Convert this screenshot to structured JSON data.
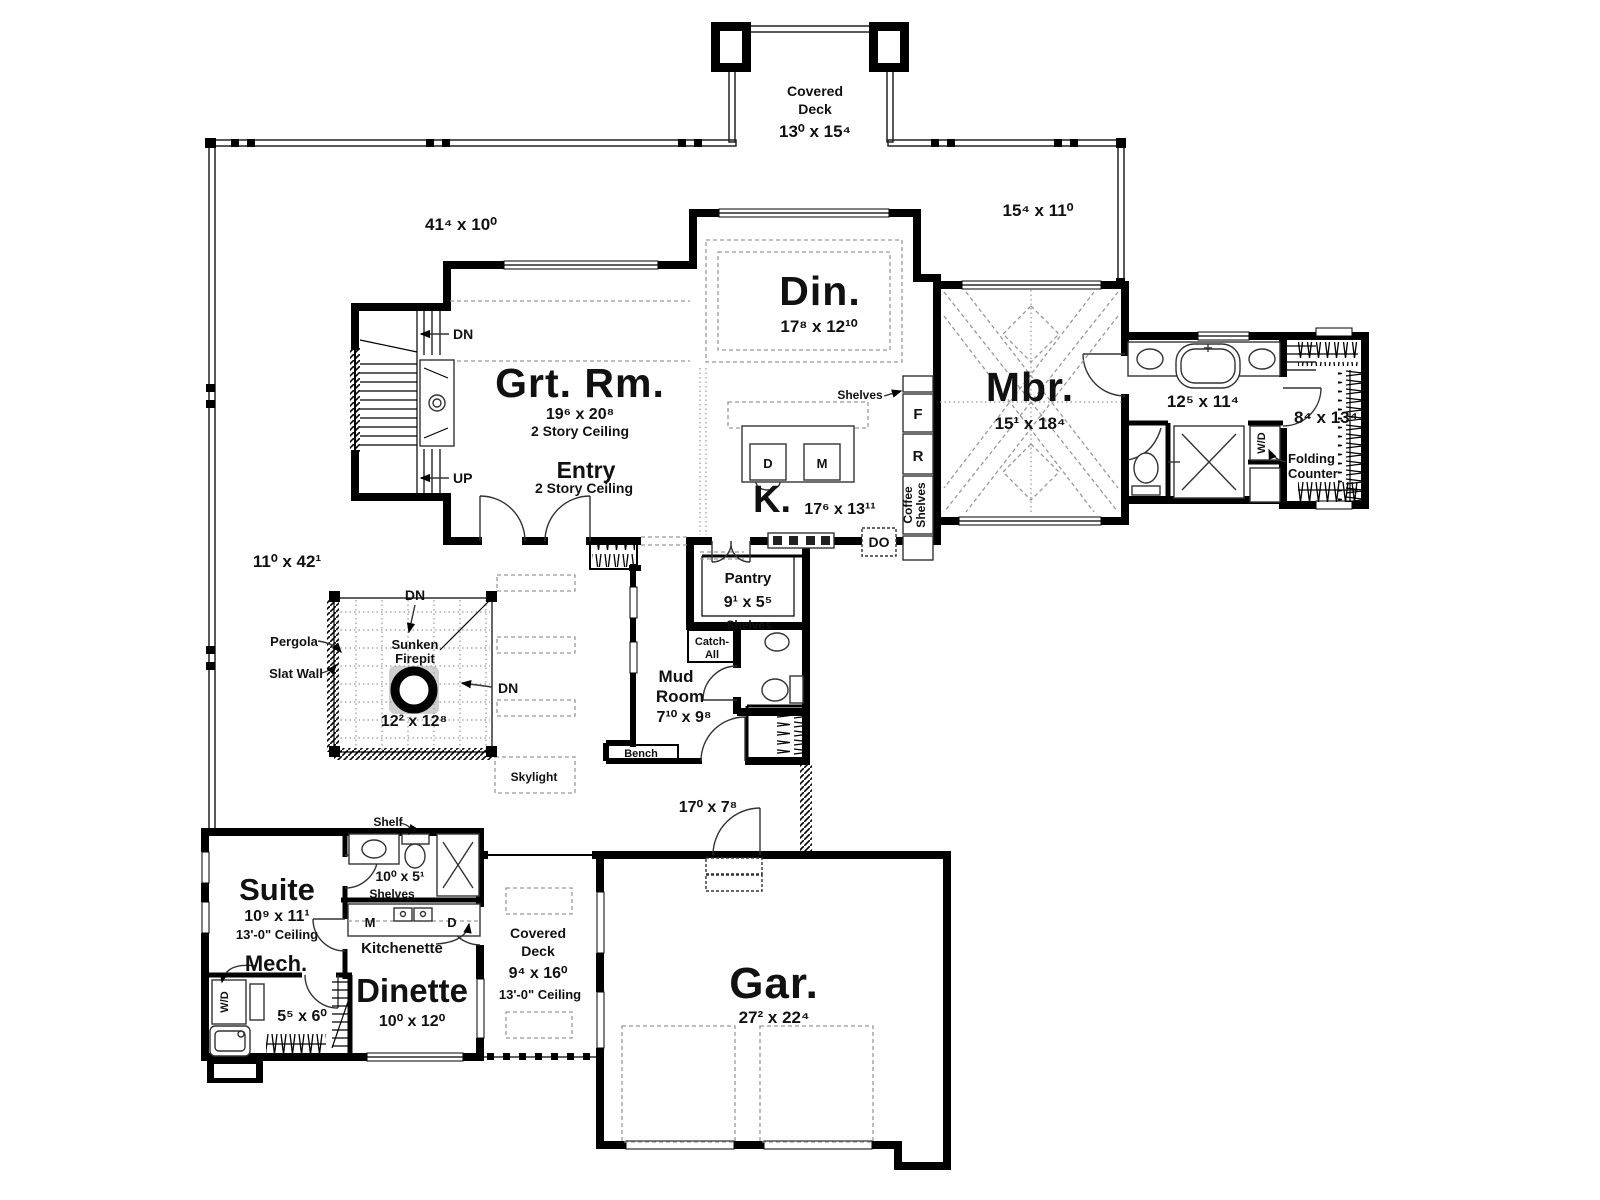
{
  "deck_top": {
    "line1": "Covered",
    "line2": "Deck",
    "dim": "13⁰ x 15⁴"
  },
  "deck_dims": {
    "top_left": "41⁴ x 10⁰",
    "right": "15⁴ x 11⁰",
    "left": "11⁰ x 42¹"
  },
  "great_room": {
    "name": "Grt. Rm.",
    "dim": "19⁶ x 20⁸",
    "ceiling": "2 Story Ceiling"
  },
  "entry": {
    "name": "Entry",
    "ceiling": "2 Story Ceiling"
  },
  "dining": {
    "name": "Din.",
    "dim": "17⁸ x 12¹⁰"
  },
  "kitchen": {
    "name": "K.",
    "dim": "17⁶ x 13¹¹",
    "d": "D",
    "m": "M",
    "f": "F",
    "r": "R",
    "do_label": "DO",
    "shelves": "Shelves",
    "coffee1": "Coffee",
    "coffee2": "Shelves"
  },
  "master": {
    "name": "Mbr.",
    "dim": "15¹ x 18⁴"
  },
  "master_bath": {
    "dim": "12⁵ x 11⁴",
    "wd": "W/D"
  },
  "master_closet": {
    "dim": "8⁴ x 13⁴",
    "folding1": "Folding",
    "folding2": "Counter"
  },
  "pantry": {
    "name": "Pantry",
    "dim": "9¹ x 5⁵",
    "shelves": "Shelves"
  },
  "mud_room": {
    "line1": "Mud",
    "line2": "Room",
    "dim": "7¹⁰ x 9⁸",
    "catch1": "Catch-",
    "catch2": "All",
    "bench": "Bench"
  },
  "stairs": {
    "dn": "DN",
    "up": "UP"
  },
  "pergola": {
    "label": "Pergola",
    "slat_wall": "Slat Wall",
    "firepit1": "Sunken",
    "firepit2": "Firepit",
    "firepit_dim": "12² x 12⁸",
    "dn": "DN",
    "skylight": "Skylight"
  },
  "walkway": {
    "dim": "17⁰ x 7⁸"
  },
  "suite": {
    "name": "Suite",
    "dim": "10⁹ x 11¹",
    "ceiling": "13'-0\" Ceiling",
    "shelf": "Shelf",
    "bath_dim": "10⁰ x 5¹",
    "shelves": "Shelves"
  },
  "mech": {
    "name": "Mech.",
    "dim": "5⁵ x 6⁰",
    "wd": "W/D"
  },
  "kitchenette": {
    "name": "Kitchenette",
    "m": "M",
    "d": "D"
  },
  "dinette": {
    "name": "Dinette",
    "dim": "10⁰ x 12⁰"
  },
  "deck_south": {
    "line1": "Covered",
    "line2": "Deck",
    "dim": "9⁴ x 16⁰",
    "ceiling": "13'-0\" Ceiling"
  },
  "garage": {
    "name": "Gar.",
    "dim": "27² x 22⁴"
  }
}
